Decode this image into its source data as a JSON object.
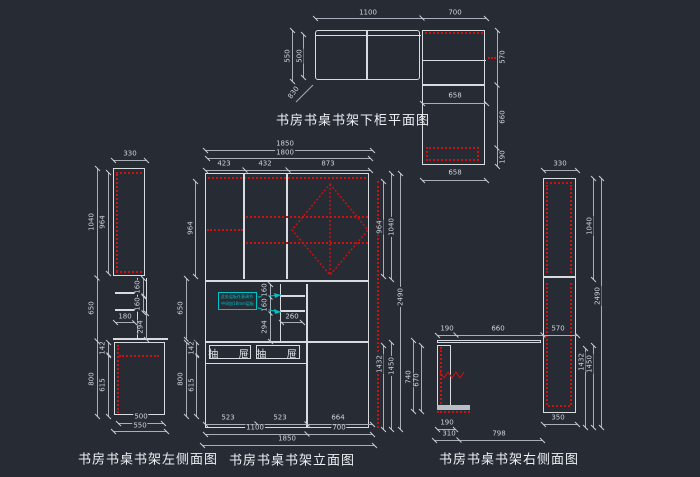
{
  "canvas": {
    "background": "#262b34",
    "line_color": "#d8dce1",
    "red": "#d01010",
    "cyan": "#00c2c8"
  },
  "views": {
    "plan": {
      "title": "书房书桌书架下柜平面图",
      "dims": {
        "top_w_left": "1100",
        "top_w_right": "700",
        "left_outer": "550",
        "left_inner": "500",
        "diag": "830",
        "right_top": "570",
        "right_mid": "660",
        "right_bot": "190",
        "mid_w": "658",
        "bot_w": "658"
      }
    },
    "left": {
      "title": "书房书桌书架左侧面图",
      "dims": {
        "top_w": "330",
        "upper_outer": "1040",
        "upper_inner": "964",
        "mid": "650",
        "shelf_a": "160",
        "shelf_b": "160",
        "shelf_w": "180",
        "below_shelf": "294",
        "desk_lip": "142",
        "lower_outer": "800",
        "lower_inner": "615",
        "bot_inner": "500",
        "bot_outer": "550"
      }
    },
    "elevation": {
      "title": "书房书桌书架立面图",
      "drawer_left": "抽 屉",
      "drawer_right": "抽 屉",
      "note": {
        "line1": "此处层板任意调节",
        "line2": "中间加18mm层板"
      },
      "dims": {
        "total_w": "1850",
        "inner_w": "1800",
        "sec_a": "423",
        "sec_b": "432",
        "sec_c": "873",
        "left_upper_inner": "964",
        "left_mid": "650",
        "left_lower": "800",
        "left_lip": "142",
        "left_lower_inner": "615",
        "nook_a": "160",
        "nook_b": "160",
        "nook_c": "294",
        "nook_w": "260",
        "right_upper_inner": "964",
        "right_upper": "1040",
        "right_total": "2490",
        "right_lower_inner": "1432",
        "right_lower": "1450",
        "bot_a": "523",
        "bot_b": "523",
        "bot_c": "664",
        "bot_left": "1100",
        "bot_right": "700",
        "bot_total": "1850"
      }
    },
    "right": {
      "title": "书房书桌书架右侧面图",
      "dims": {
        "top_w": "330",
        "desk_a": "190",
        "desk_b": "660",
        "desk_c": "570",
        "desk_h_outer": "740",
        "desk_h_inner": "670",
        "col_bot": "350",
        "leg_bot_a": "190",
        "leg_bot_b": "310",
        "desk_bot": "798",
        "upper": "1040",
        "total": "2490",
        "lower_inner": "1432",
        "lower": "1450"
      }
    }
  }
}
